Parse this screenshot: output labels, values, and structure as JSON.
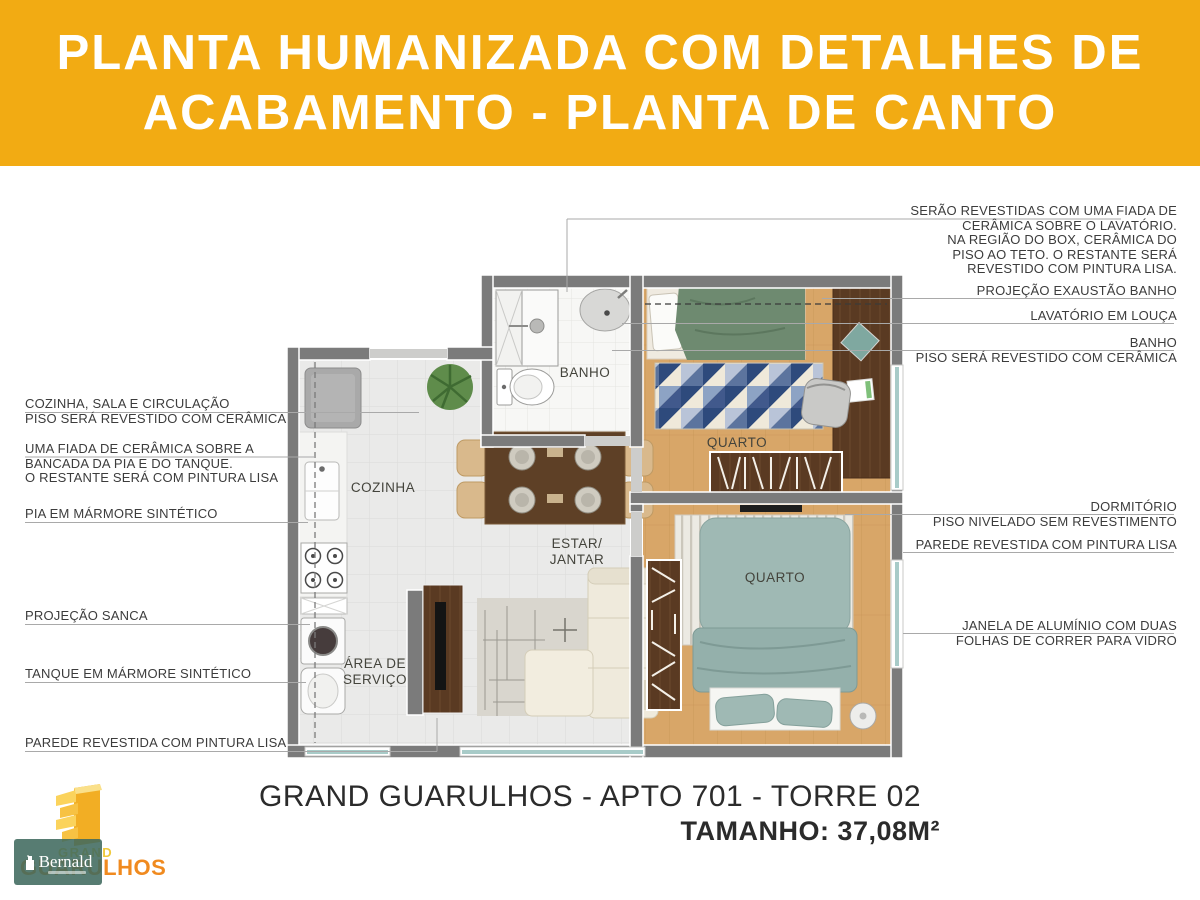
{
  "header": {
    "line1": "PLANTA HUMANIZADA COM DETALHES DE",
    "line2": "ACABAMENTO - PLANTA DE CANTO"
  },
  "colors": {
    "header_bg": "#F2AB13",
    "accent_orange": "#F08A1F",
    "watermark_teal": "#406A5F",
    "wall_gray": "#7B7B7B",
    "wood_floor": "#D8A668",
    "green_bed": "#6E8A70",
    "teal_bed": "#9FB9B4",
    "rug_navy": "#2E4A7C"
  },
  "plan": {
    "rooms": {
      "banho": "BANHO",
      "quarto1": "QUARTO",
      "cozinha": "COZINHA",
      "estar_l1": "ESTAR/",
      "estar_l2": "JANTAR",
      "area_l1": "ÁREA DE",
      "area_l2": "SERVIÇO",
      "quarto2": "QUARTO"
    }
  },
  "annotations_left": [
    {
      "lines": [
        "COZINHA, SALA E CIRCULAÇÃO",
        "PISO SERÁ REVESTIDO COM CERÂMICA"
      ]
    },
    {
      "lines": [
        "UMA FIADA DE CERÂMICA SOBRE A",
        "BANCADA DA PIA E DO TANQUE.",
        "O RESTANTE SERÁ COM PINTURA LISA"
      ]
    },
    {
      "lines": [
        "PIA EM MÁRMORE SINTÉTICO"
      ]
    },
    {
      "lines": [
        "PROJEÇÃO SANCA"
      ]
    },
    {
      "lines": [
        "TANQUE EM MÁRMORE SINTÉTICO"
      ]
    },
    {
      "lines": [
        "PAREDE REVESTIDA COM PINTURA LISA"
      ]
    }
  ],
  "annotations_right": [
    {
      "lines": [
        "SERÃO REVESTIDAS COM UMA FIADA DE",
        "CERÂMICA SOBRE O LAVATÓRIO.",
        "NA REGIÃO DO BOX, CERÂMICA DO",
        "PISO AO TETO. O RESTANTE SERÁ",
        "REVESTIDO COM PINTURA LISA."
      ]
    },
    {
      "lines": [
        "PROJEÇÃO EXAUSTÃO BANHO"
      ]
    },
    {
      "lines": [
        "LAVATÓRIO EM LOUÇA"
      ]
    },
    {
      "lines": [
        "BANHO",
        "PISO SERÁ REVESTIDO COM CERÂMICA"
      ]
    },
    {
      "lines": [
        "DORMITÓRIO",
        "PISO NIVELADO SEM REVESTIMENTO"
      ]
    },
    {
      "lines": [
        "PAREDE REVESTIDA COM PINTURA LISA"
      ]
    },
    {
      "lines": [
        "JANELA DE ALUMÍNIO COM DUAS",
        "FOLHAS DE CORRER PARA VIDRO"
      ]
    }
  ],
  "footer": {
    "title": "GRAND GUARULHOS - APTO 701 - TORRE 02",
    "size": "TAMANHO: 37,08M²"
  },
  "logo": {
    "grand": "GRAND",
    "guarulhos": "GUARULHOS",
    "watermark": "Bernald"
  }
}
